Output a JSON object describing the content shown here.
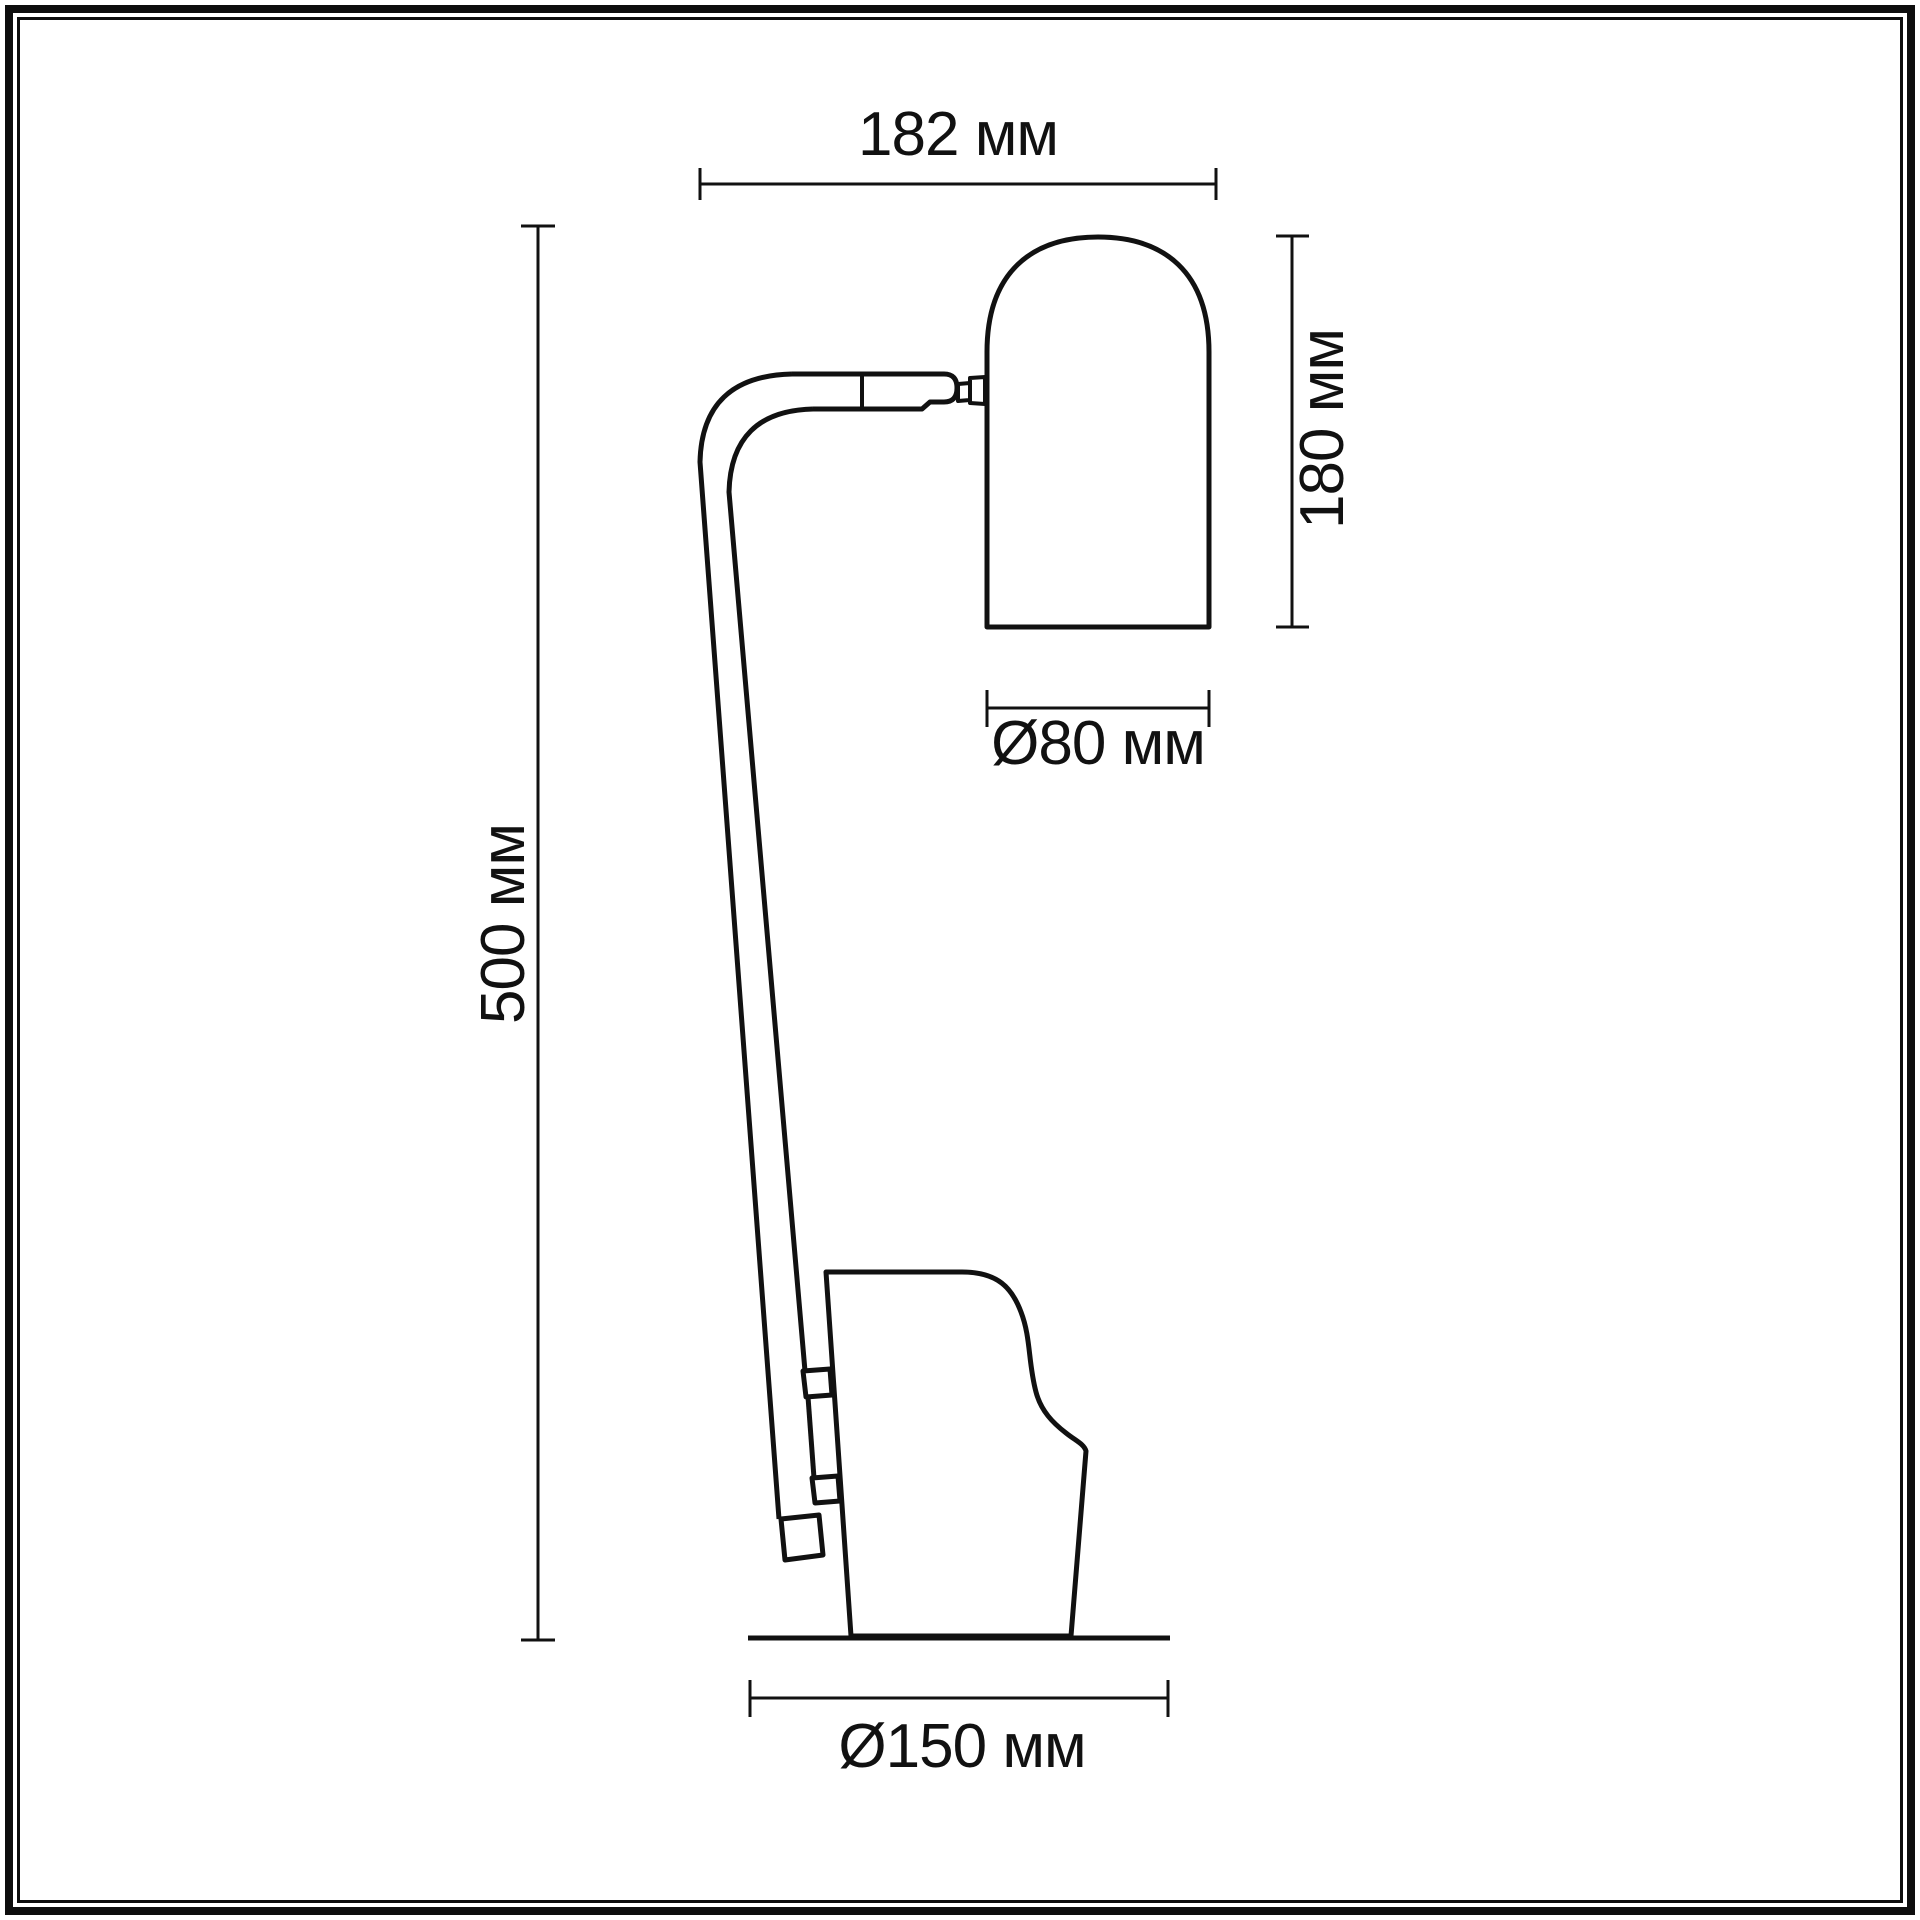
{
  "page": {
    "background": "#ffffff",
    "line_color": "#111111"
  },
  "drawing": {
    "type": "technical-dimension-drawing",
    "subject": "table-lamp-side-view",
    "unit": "мм",
    "dimensions": {
      "shade_span_top": {
        "label": "182 мм",
        "value": 182,
        "unit": "мм",
        "orientation": "horizontal"
      },
      "shade_height": {
        "label": "180 мм",
        "value": 180,
        "unit": "мм",
        "orientation": "vertical"
      },
      "shade_diameter": {
        "label": "Ø80 мм",
        "value": 80,
        "unit": "мм",
        "orientation": "horizontal"
      },
      "total_height": {
        "label": "500 мм",
        "value": 500,
        "unit": "мм",
        "orientation": "vertical"
      },
      "base_diameter": {
        "label": "Ø150 мм",
        "value": 150,
        "unit": "мм",
        "orientation": "horizontal"
      }
    }
  }
}
